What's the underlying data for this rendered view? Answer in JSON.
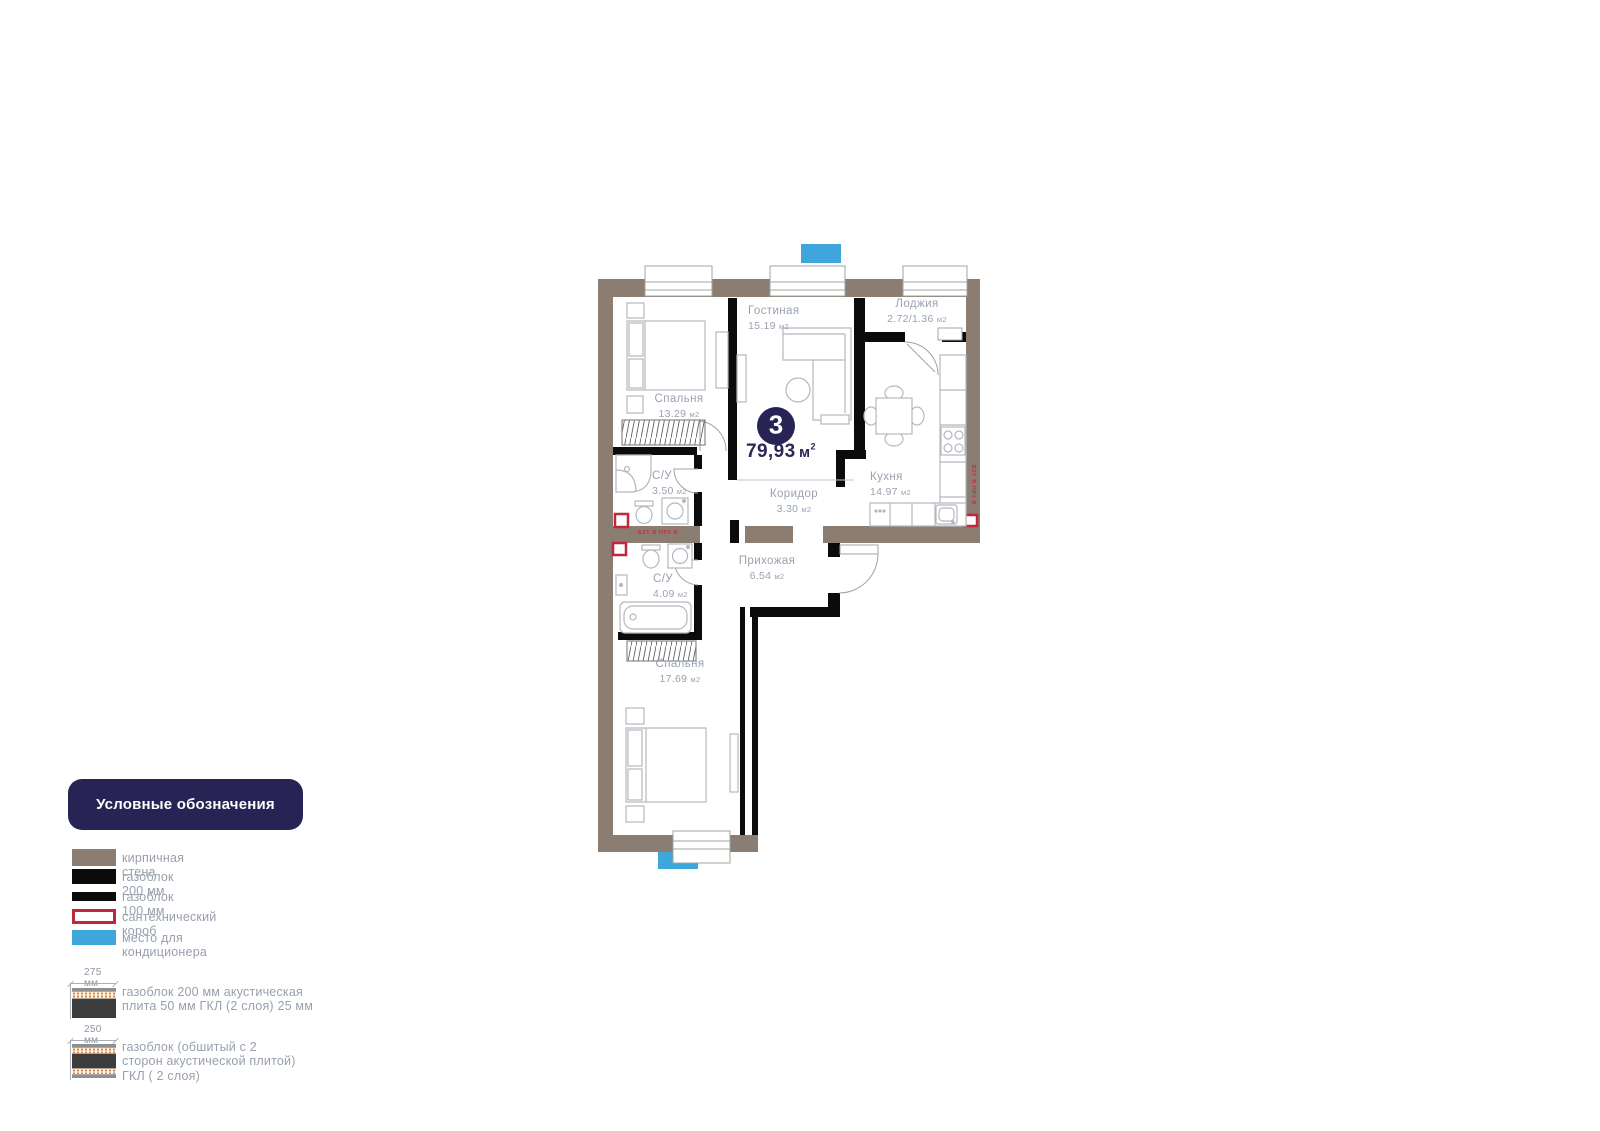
{
  "plan": {
    "badge": {
      "number": "3",
      "area": "79,93",
      "unit": "м",
      "unit_sup": "2"
    },
    "rooms": [
      {
        "name": "Спальня",
        "area": "13.29",
        "unit": "м2"
      },
      {
        "name": "Гостиная",
        "area": "15.19",
        "unit": "м2"
      },
      {
        "name": "Лоджия",
        "area": "2.72/1.36",
        "unit": "м2"
      },
      {
        "name": "Кухня",
        "area": "14.97",
        "unit": "м2"
      },
      {
        "name": "С/У",
        "area": "3.50",
        "unit": "м2"
      },
      {
        "name": "Коридор",
        "area": "3.30",
        "unit": "м2"
      },
      {
        "name": "Прихожая",
        "area": "6.54",
        "unit": "м2"
      },
      {
        "name": "С/У",
        "area": "4.09",
        "unit": "м2"
      },
      {
        "name": "Спальня",
        "area": "17.69",
        "unit": "м2"
      }
    ],
    "annotations": {
      "riser_horizontal": "Б2Т В ПР3 В",
      "riser_vertical": "Б2Т В ПР3 В"
    }
  },
  "legend": {
    "title": "Условные обозначения",
    "items": [
      {
        "label": "кирпичная стена"
      },
      {
        "label": "газоблок 200 мм"
      },
      {
        "label": "газоблок 100 мм"
      },
      {
        "label": "сантехнический короб"
      },
      {
        "label": "место для кондиционера"
      },
      {
        "dim": "275 мм",
        "label": "газоблок 200 мм акустическая плита 50 мм ГКЛ (2 слоя) 25 мм"
      },
      {
        "dim": "250 мм",
        "label": "газоблок (обшитый с 2 сторон акустической плитой) ГКЛ ( 2 слоя)"
      }
    ]
  },
  "colors": {
    "brick": "#8b7d71",
    "gasblock": "#0b0b0b",
    "ac_blue": "#3fa6db",
    "plumbing_red": "#c0273a",
    "navy": "#272354",
    "label_gray": "#9aa2b0"
  }
}
